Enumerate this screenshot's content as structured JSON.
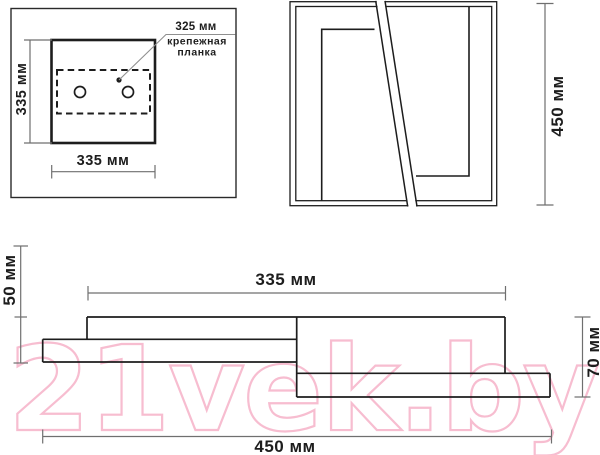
{
  "drawing": {
    "watermark_text": "21vek.by",
    "colors": {
      "line": "#1d1d1d",
      "dimension": "#6f6f6f",
      "leader": "#8f8f8f",
      "watermark_pink": "#f7bdd0"
    },
    "top_view": {
      "height_label": "335 мм",
      "width_label": "335 мм",
      "plate_width_label": "325 мм",
      "plate_caption_line1": "крепежная",
      "plate_caption_line2": "планка"
    },
    "front_view": {
      "height_label": "450 мм"
    },
    "side_view": {
      "body_width_label": "335 мм",
      "left_height_label": "50 мм",
      "right_height_label": "70 мм",
      "total_width_label": "450 мм"
    }
  }
}
